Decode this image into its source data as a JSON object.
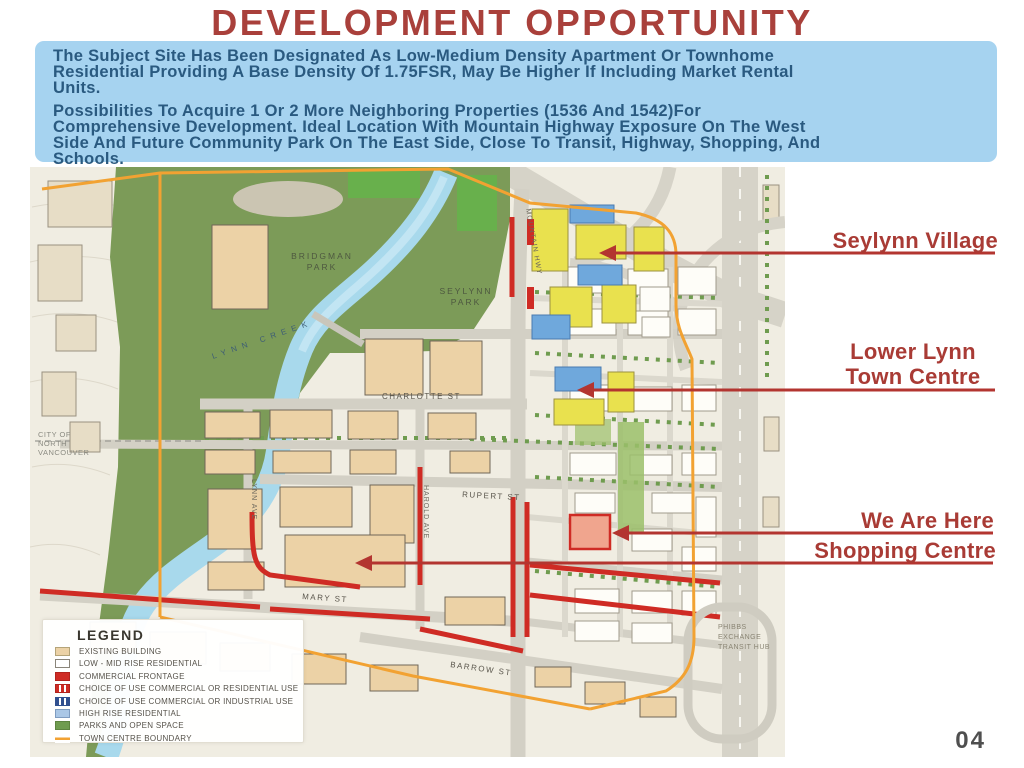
{
  "page": {
    "title": "DEVELOPMENT OPPORTUNITY",
    "page_number": "04"
  },
  "intro": {
    "p1": [
      "The Subject Site Has Been Designated As Low-Medium Density Apartment Or Townhome",
      "Residential Providing A Base Density Of 1.75FSR, May Be Higher If Including Market Rental",
      "Units."
    ],
    "p2": [
      "Possibilities To Acquire 1 Or 2 More Neighboring Properties (1536 And 1542)For",
      "Comprehensive Development. Ideal Location With Mountain Highway Exposure On The West",
      "Side And Future Community Park On The East Side, Close To Transit, Highway, Shopping, And",
      "Schools."
    ]
  },
  "annotations": {
    "seylynn_village": "Seylynn Village",
    "lower_lynn_line1": "Lower Lynn",
    "lower_lynn_line2": "Town Centre",
    "we_are_here": "We Are Here",
    "shopping_centre": "Shopping Centre"
  },
  "map": {
    "labels": {
      "bridgman": [
        "BRIDGMAN",
        "PARK"
      ],
      "seylynn": [
        "SEYLYNN",
        "PARK"
      ],
      "lynn_creek": "LYNN  CREEK",
      "city": [
        "CITY OF",
        "NORTH",
        "VANCOUVER"
      ],
      "charlotte_st": "CHARLOTTE  ST",
      "rupert_st": "RUPERT  ST",
      "mary_st": "MARY  ST",
      "barrow_st": "BARROW  ST",
      "lynn_ave": "LYNN AVE",
      "harold_ave": "HAROLD AVE",
      "mountain_hwy": "MOUNTAIN HWY",
      "phibbs": [
        "PHIBBS",
        "EXCHANGE",
        "TRANSIT HUB"
      ]
    }
  },
  "legend": {
    "title": "LEGEND",
    "items": [
      {
        "label": "EXISTING BUILDING",
        "color": "#ecd2a6",
        "style": "solid"
      },
      {
        "label": "LOW - MID RISE RESIDENTIAL",
        "color": "#ffffff",
        "style": "solid"
      },
      {
        "label": "COMMERCIAL FRONTAGE",
        "color": "#cf2b24",
        "style": "solid"
      },
      {
        "label": "CHOICE OF USE COMMERCIAL OR RESIDENTIAL USE",
        "color": "#cf2b24",
        "style": "red-stripes"
      },
      {
        "label": "CHOICE OF USE COMMERCIAL OR INDUSTRIAL USE",
        "color": "#31508f",
        "style": "blue-stripes"
      },
      {
        "label": "HIGH RISE RESIDENTIAL",
        "color": "#aac7e6",
        "style": "solid"
      },
      {
        "label": "PARKS AND OPEN SPACE",
        "color": "#6f9c4f",
        "style": "solid"
      },
      {
        "label": "TOWN CENTRE BOUNDARY",
        "color": "#f2a232",
        "style": "line"
      }
    ]
  },
  "colors": {
    "title_red": "#a9403b",
    "panel_blue": "#a6d3f0",
    "panel_text": "#2a5a80",
    "annotation_red": "#a93b35",
    "boundary_orange": "#f2a232",
    "commercial_red": "#cf2b24",
    "park_green": "#7c9b58",
    "creek_blue": "#a8d9ec"
  }
}
